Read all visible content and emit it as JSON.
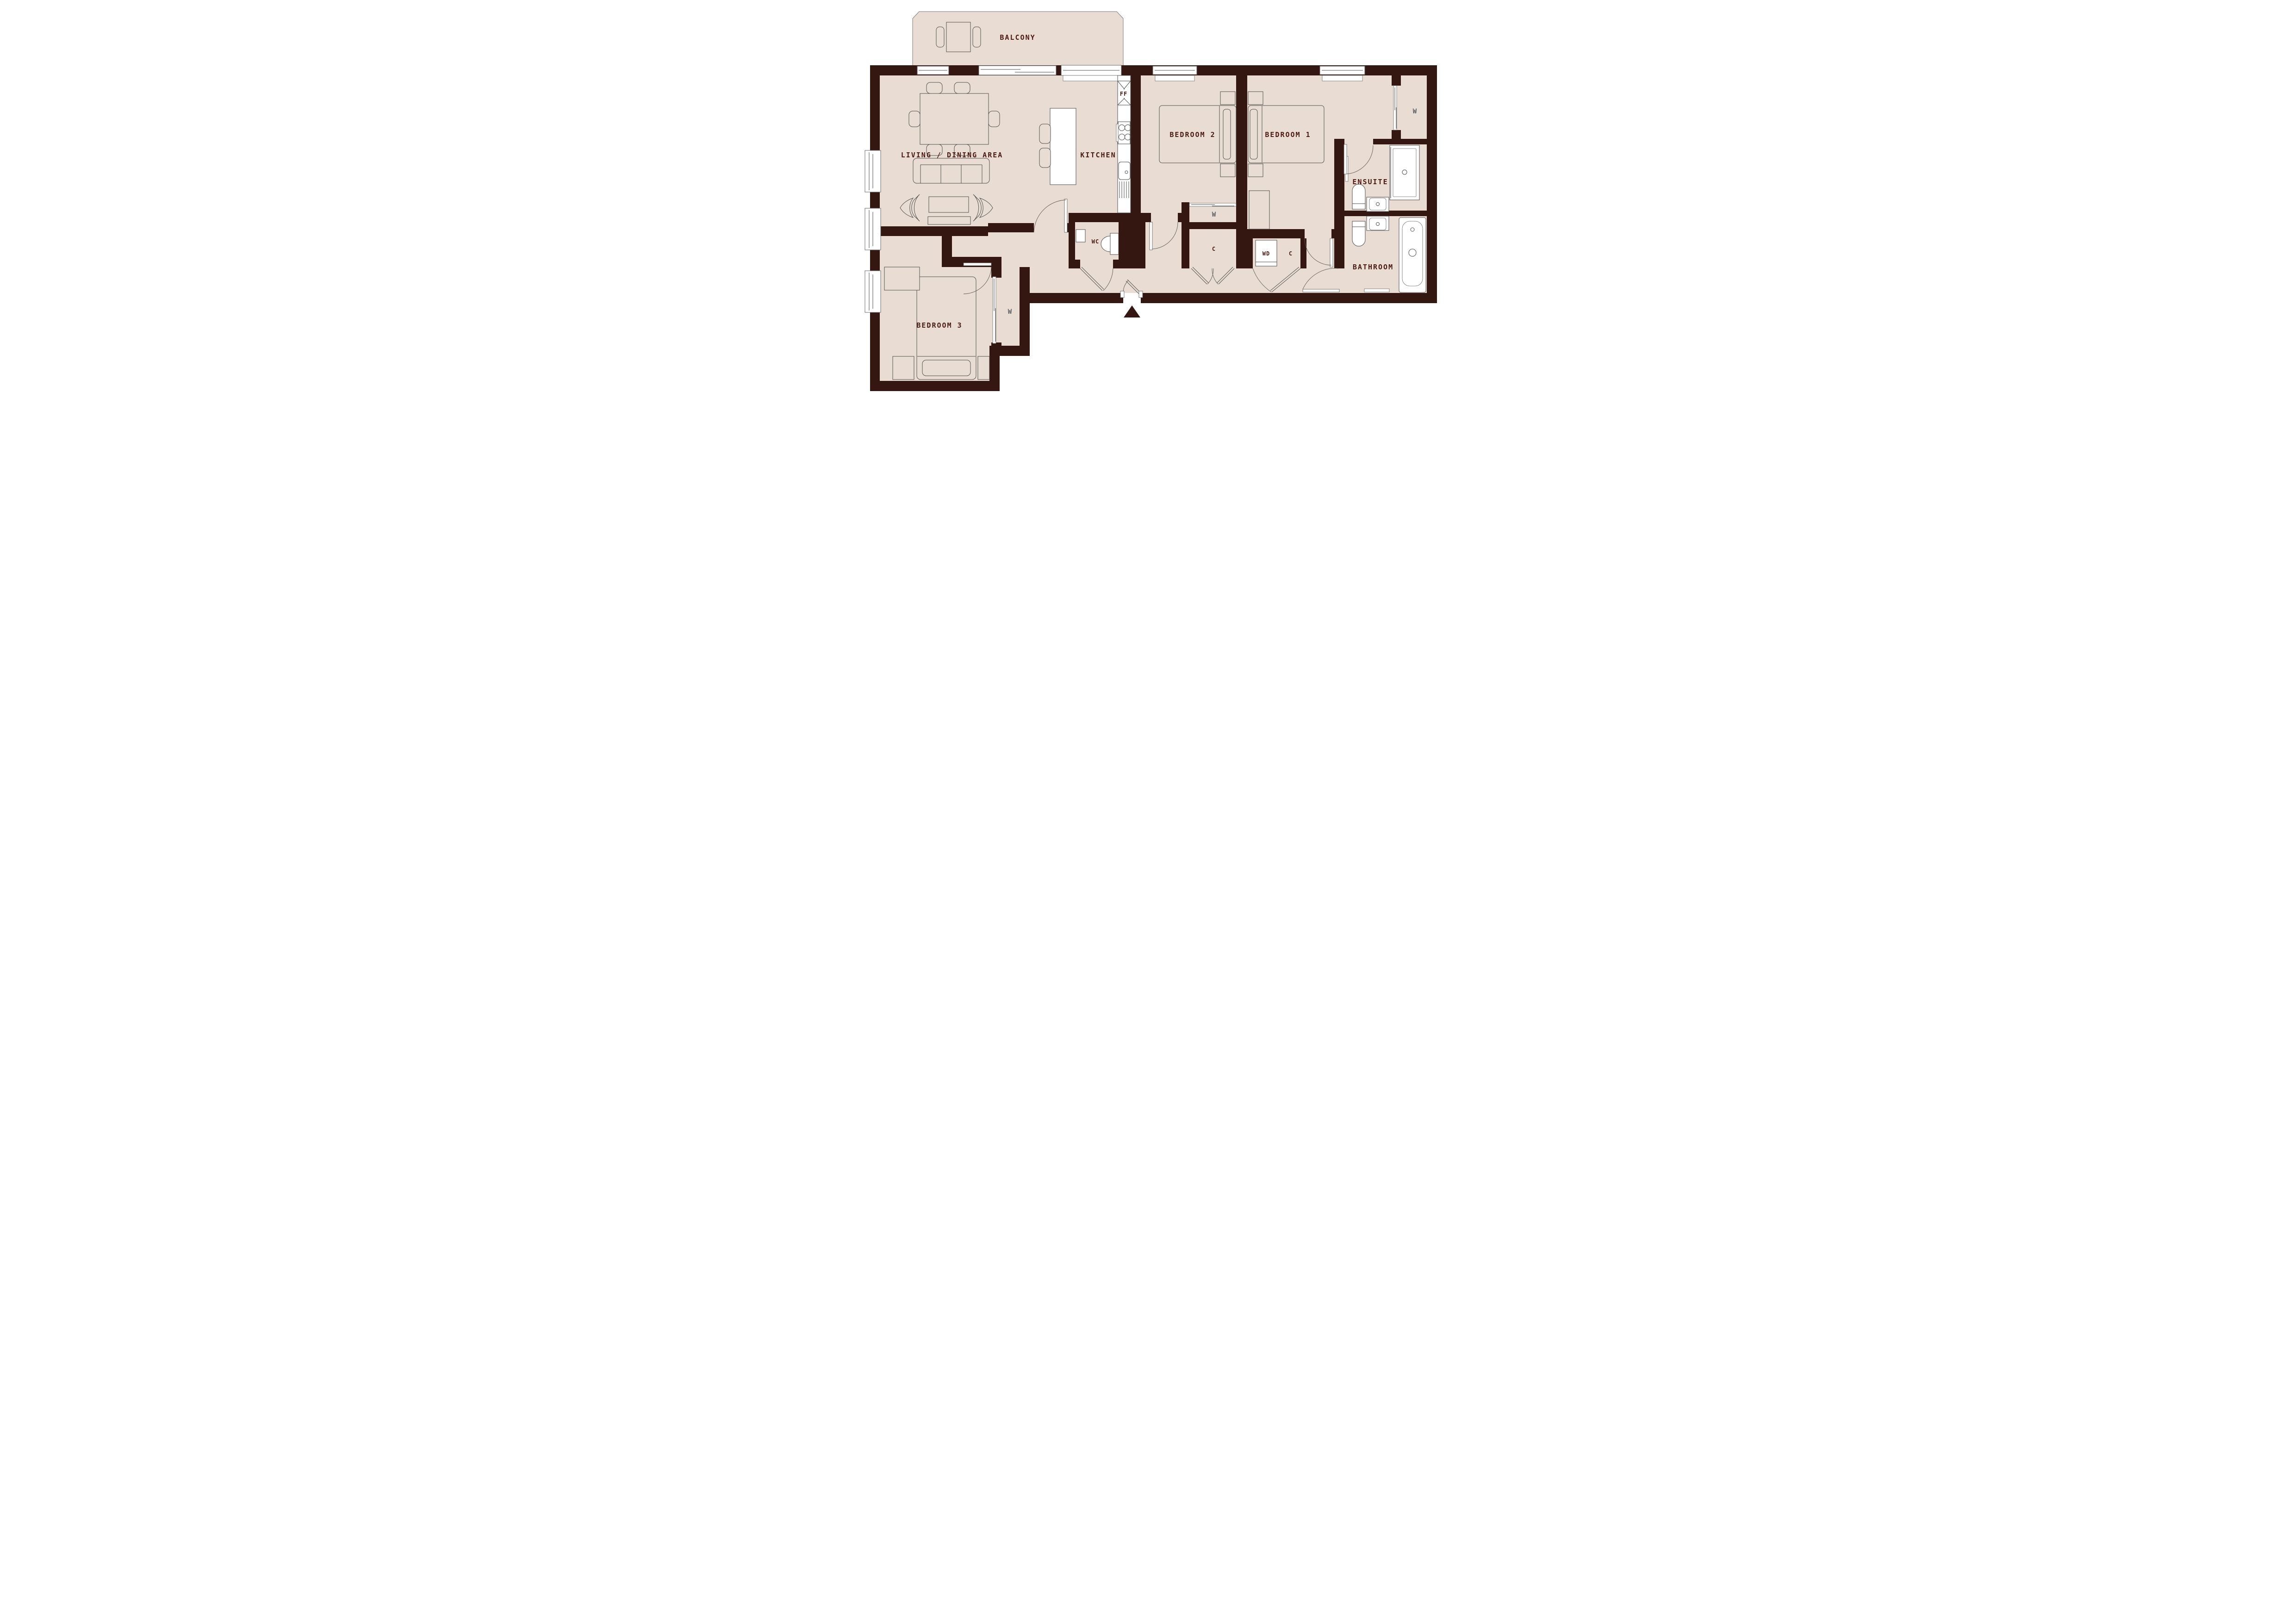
{
  "plan": {
    "rooms": {
      "balcony": "BALCONY",
      "living_dining": "LIVING / DINING AREA",
      "kitchen": "KITCHEN",
      "bedroom1": "BEDROOM 1",
      "bedroom2": "BEDROOM 2",
      "bedroom3": "BEDROOM 3",
      "ensuite": "ENSUITE",
      "bathroom": "BATHROOM",
      "wc": "WC"
    },
    "fixtures": {
      "fridge_freezer": "FF",
      "washer_dryer": "WD",
      "cupboard": "C",
      "wardrobe": "W"
    },
    "colors": {
      "wall": "#351712",
      "floor": "#e9ddd3",
      "room_label": "#4a1a10",
      "wardrobe_label": "#5d6166",
      "outline": "#4f4f4f"
    }
  }
}
